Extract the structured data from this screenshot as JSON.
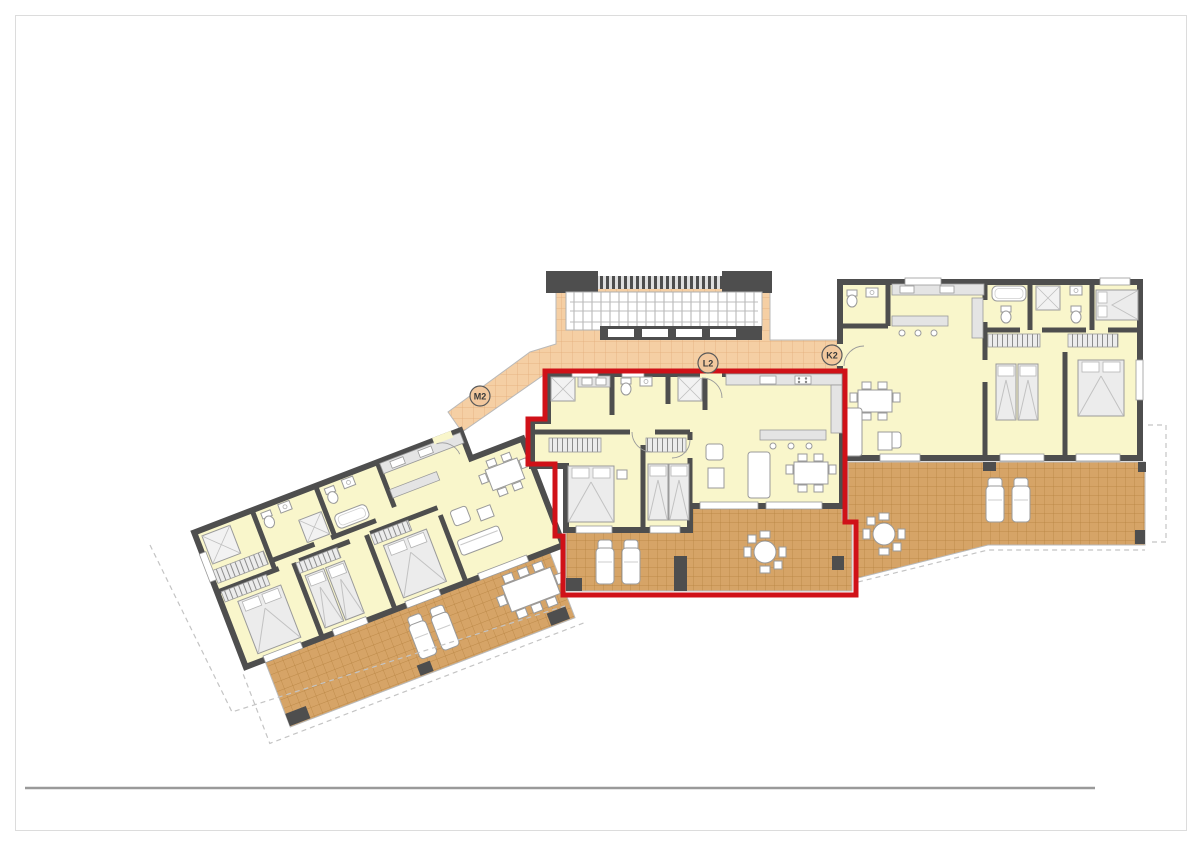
{
  "page": {
    "background": "#ffffff",
    "frame_border_color": "#dcdcdc",
    "footer_rule_color": "#9a9a9a"
  },
  "plan": {
    "type": "residential-floor-plan",
    "description": "Apartment block floor plan with three units; middle unit outlined in red",
    "highlight_color": "#d01118",
    "colors": {
      "wall": "#4e4e4e",
      "interior_floor": "#f9f6cb",
      "terrace_tile": "#d6a467",
      "terrace_tile_line": "#b5823f",
      "corridor_tile": "#f5cfa4",
      "corridor_tile_line": "#e3ab79"
    },
    "units": [
      {
        "id": "M2",
        "label": "M2",
        "highlighted": false
      },
      {
        "id": "L2",
        "label": "L2",
        "highlighted": true
      },
      {
        "id": "K2",
        "label": "K2",
        "highlighted": false
      }
    ]
  }
}
